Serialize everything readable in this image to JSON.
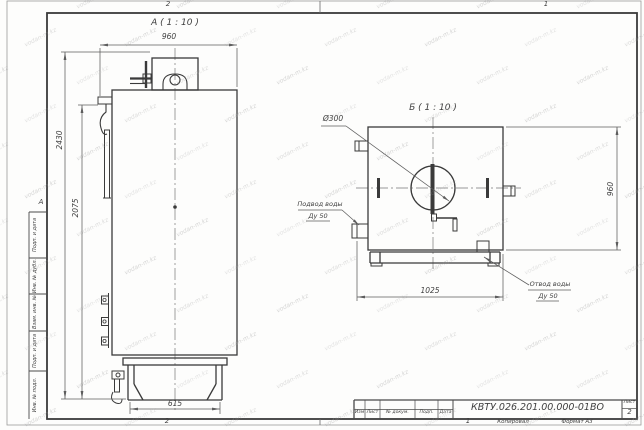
{
  "sheet": {
    "view_a": {
      "title": "А ( 1 : 10 )",
      "dim_width": "960",
      "dim_height": "2430",
      "dim_door": "2075",
      "dim_base": "615"
    },
    "view_b": {
      "title": "Б ( 1 : 10 )",
      "dim_chimney": "Ø300",
      "dim_height": "960",
      "dim_width": "1025",
      "inlet_line1": "Подвод воды",
      "inlet_line2": "Ду 50",
      "outlet_line1": "Отвод воды",
      "outlet_line2": "Ду 50"
    },
    "zones": {
      "top_left": "2",
      "top_right": "1",
      "bottom_left": "2",
      "bottom_right": "1",
      "left_letter": "А"
    },
    "side_stamp": {
      "cell1": "Подп. и дата",
      "cell2": "Инв. № дубл.",
      "cell3": "Взам. инв. №",
      "cell4": "Подп. и дата",
      "cell5": "Инв. № подл."
    },
    "title_block": {
      "doc_number": "КВТУ.026.201.00.000-01ВО",
      "col_izm": "Изм",
      "col_list": "Лист",
      "col_doc": "№ докум.",
      "col_sign": "Подп.",
      "col_date": "Дата",
      "sheet_label": "Лист",
      "sheet_number": "2",
      "footer_copied": "Копировал",
      "footer_format": "Формат А3"
    },
    "watermark": {
      "text": "vodan-m.kz"
    }
  }
}
